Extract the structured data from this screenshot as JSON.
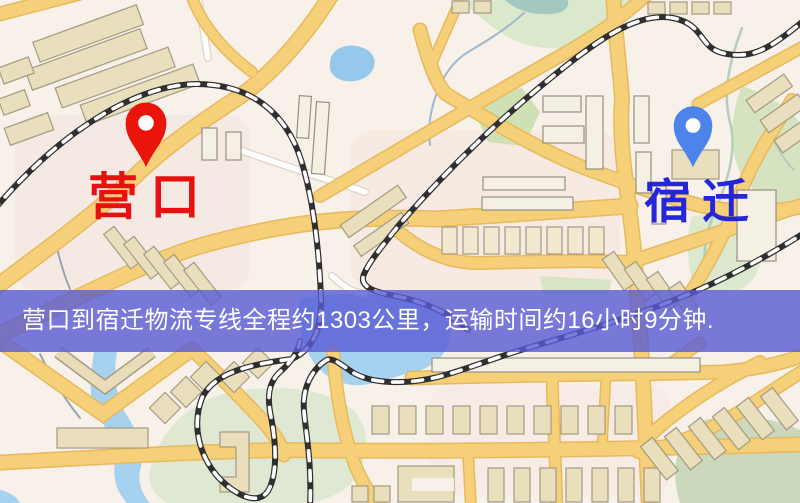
{
  "banner": {
    "text": "营口到宿迁物流专线全程约1303公里，运输时间约16小时9分钟.",
    "background_color": "#585ad4",
    "text_color": "#ffffff"
  },
  "markers": {
    "origin": {
      "name": "营口",
      "pin_color": "#e9150b",
      "label_color": "#e81111"
    },
    "destination": {
      "name": "宿迁",
      "pin_color": "#4d84ea",
      "label_color": "#2525da"
    }
  },
  "map_colors": {
    "background": "#f7f1ea",
    "road_fill": "#f6d078",
    "road_casing": "#e7b95c",
    "building_tan": "#eadfbd",
    "building_white": "#f4f0e4",
    "railway": "#2f2f2f",
    "water": "#a6d2f0",
    "park_green": "#d5e3c0"
  }
}
